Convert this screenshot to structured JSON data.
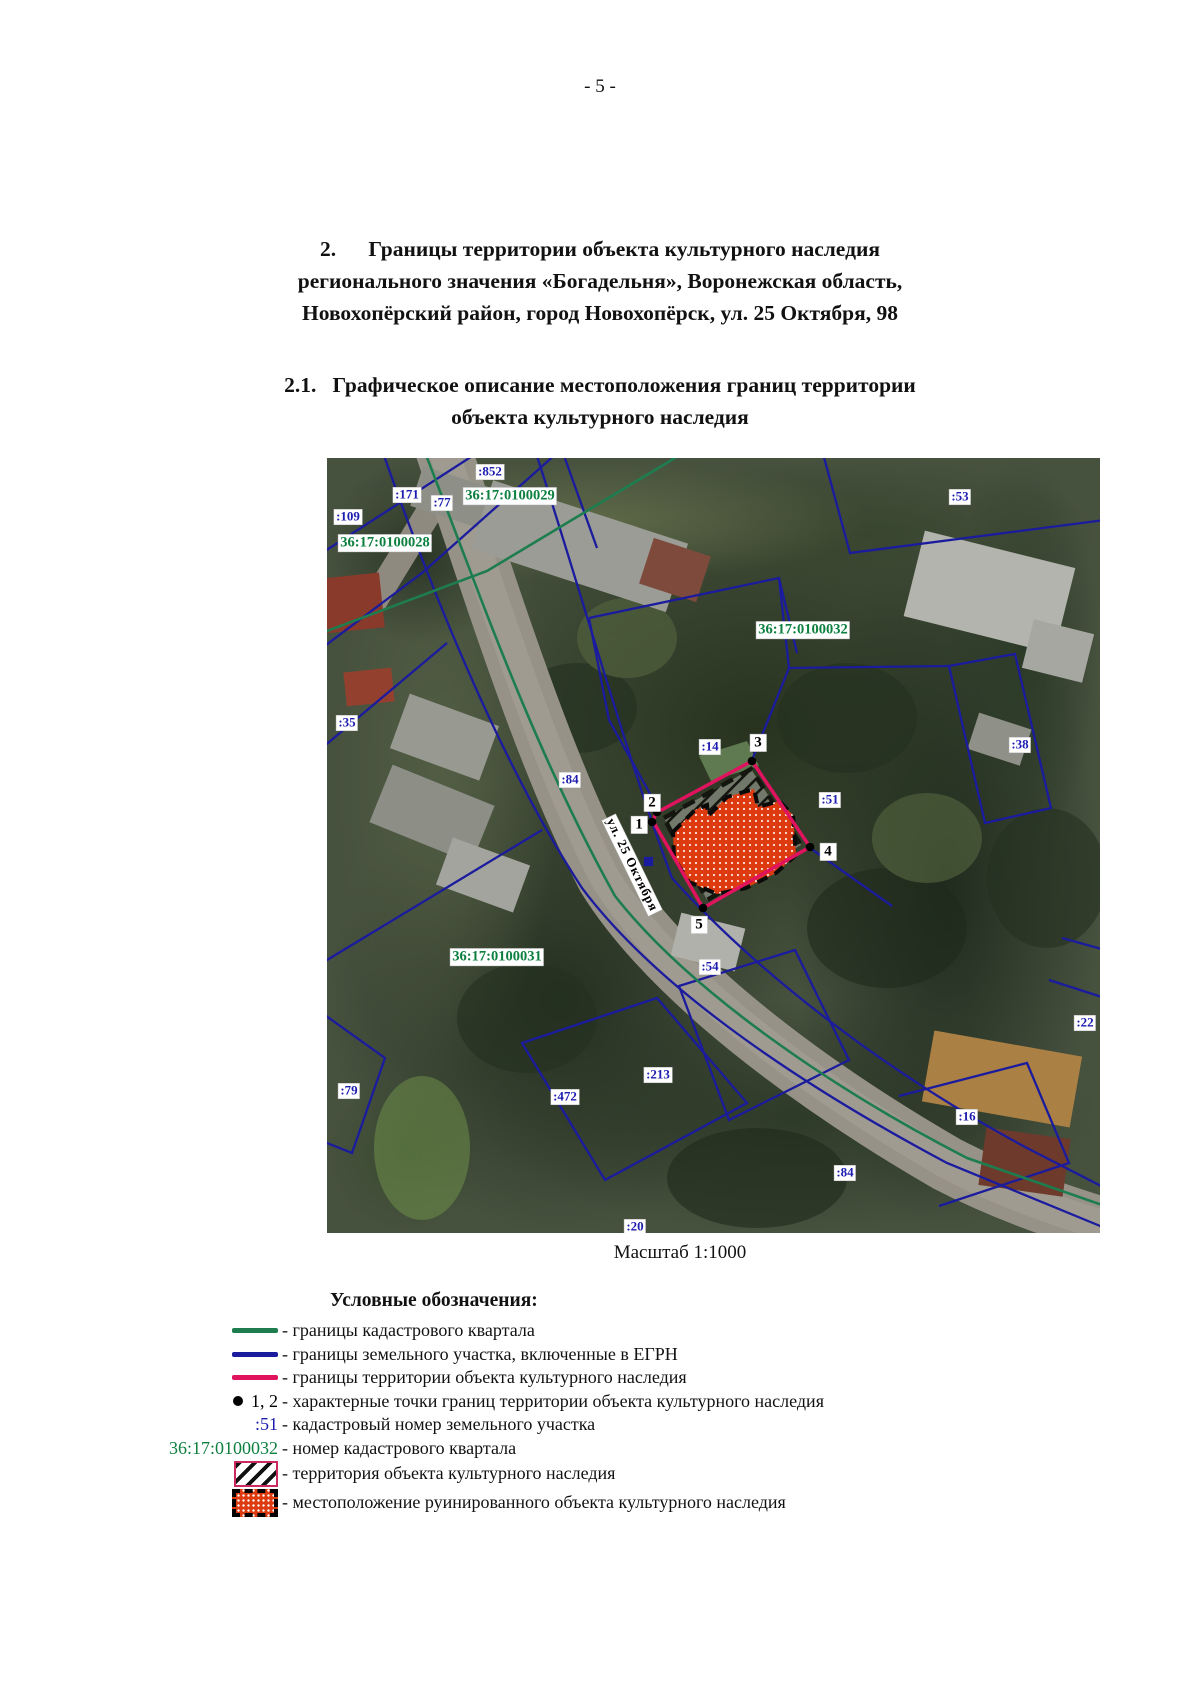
{
  "page": {
    "number": "- 5 -"
  },
  "section": {
    "line1": "2.      Границы территории объекта культурного наследия",
    "line2": "регионального значения «Богадельня», Воронежская область,",
    "line3": "Новохопёрский район, город Новохопёрск, ул. 25 Октября, 98"
  },
  "subsection": {
    "line1": "2.1.   Графическое описание местоположения границ территории",
    "line2": "объекта культурного наследия"
  },
  "map": {
    "scale_caption": "Масштаб 1:1000",
    "street_label": {
      "text": "ул. 25 Октября",
      "x": 305,
      "y": 407,
      "angle": 64
    },
    "quarter_labels": [
      {
        "text": "36:17:0100028",
        "x": 58,
        "y": 85
      },
      {
        "text": "36:17:0100029",
        "x": 183,
        "y": 38
      },
      {
        "text": "36:17:0100031",
        "x": 170,
        "y": 499
      },
      {
        "text": "36:17:0100032",
        "x": 476,
        "y": 172
      }
    ],
    "parcel_labels": [
      {
        "text": ":852",
        "x": 163,
        "y": 14
      },
      {
        "text": ":171",
        "x": 80,
        "y": 37
      },
      {
        "text": ":77",
        "x": 115,
        "y": 45
      },
      {
        "text": ":109",
        "x": 21,
        "y": 59
      },
      {
        "text": ":53",
        "x": 633,
        "y": 39
      },
      {
        "text": ":35",
        "x": 20,
        "y": 265
      },
      {
        "text": ":38",
        "x": 693,
        "y": 287
      },
      {
        "text": ":84",
        "x": 243,
        "y": 322
      },
      {
        "text": ":14",
        "x": 383,
        "y": 289
      },
      {
        "text": ":51",
        "x": 503,
        "y": 342
      },
      {
        "text": ":54",
        "x": 383,
        "y": 509
      },
      {
        "text": ":79",
        "x": 22,
        "y": 633
      },
      {
        "text": ":472",
        "x": 238,
        "y": 639
      },
      {
        "text": ":213",
        "x": 331,
        "y": 617
      },
      {
        "text": ":22",
        "x": 758,
        "y": 565
      },
      {
        "text": ":16",
        "x": 640,
        "y": 659
      },
      {
        "text": ":84",
        "x": 518,
        "y": 715
      },
      {
        "text": ":20",
        "x": 308,
        "y": 769
      }
    ],
    "point_labels": [
      {
        "text": "1",
        "x": 312,
        "y": 367
      },
      {
        "text": "2",
        "x": 325,
        "y": 345
      },
      {
        "text": "3",
        "x": 431,
        "y": 285
      },
      {
        "text": "4",
        "x": 501,
        "y": 394
      },
      {
        "text": "5",
        "x": 372,
        "y": 467
      }
    ]
  },
  "legend": {
    "title": "Условные обозначения:",
    "items": [
      {
        "swatch": "line-green",
        "label": "- границы кадастрового квартала"
      },
      {
        "swatch": "line-blue",
        "label": "- границы земельного участка, включенные в ЕГРН"
      },
      {
        "swatch": "line-crimson",
        "label": "- границы территории объекта культурного наследия"
      },
      {
        "swatch": "points",
        "swatch_text": "1, 2",
        "label": "- характерные точки границ территории объекта культурного наследия"
      },
      {
        "swatch": "text-blue",
        "swatch_text": ":51",
        "label": "- кадастровый номер земельного участка"
      },
      {
        "swatch": "text-green",
        "swatch_text": "36:17:0100032",
        "label": "- номер кадастрового квартала"
      },
      {
        "swatch": "hatch",
        "label": "- территория объекта культурного наследия"
      },
      {
        "swatch": "ruin",
        "label": "- местоположение руинированного объекта культурного наследия"
      }
    ]
  },
  "colors": {
    "quarter_line": "#1e7d4f",
    "parcel_line": "#1b1b9e",
    "heritage_line": "#e0135f",
    "parcel_label_text": "#1c1cb0",
    "quarter_label_text": "#0d8040",
    "ruin_fill": "#dd3a10"
  }
}
